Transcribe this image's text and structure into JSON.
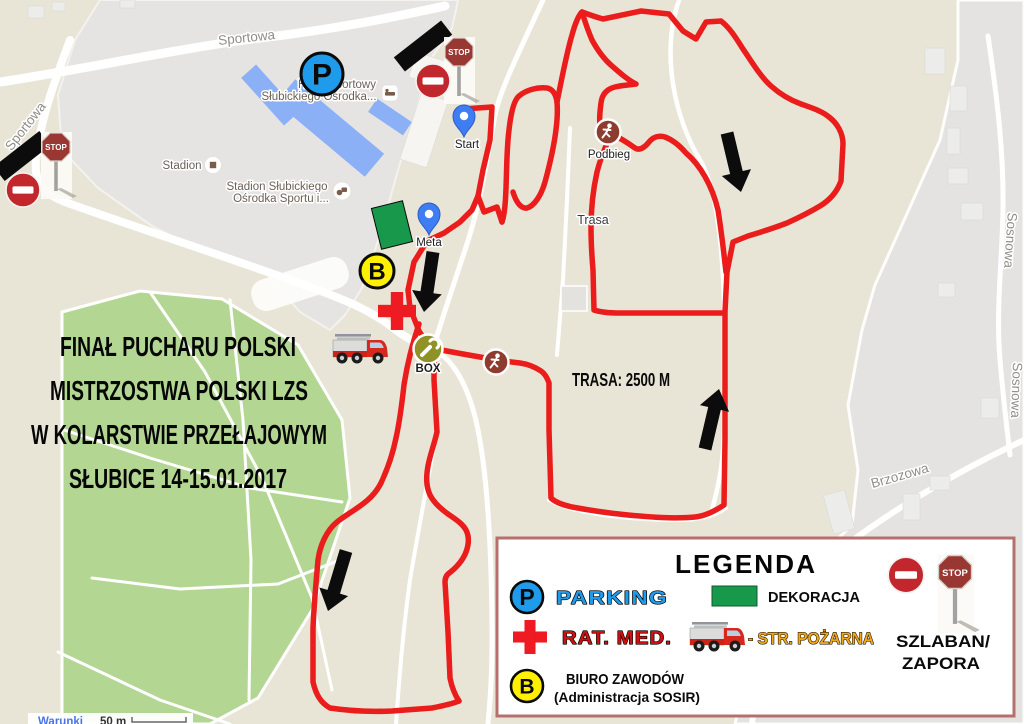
{
  "title": {
    "lines": [
      "FINAŁ PUCHARU POLSKI",
      "MISTRZOSTWA POLSKI LZS",
      "W KOLARSTWIE PRZEŁAJOWYM",
      "SŁUBICE 14-15.01.2017"
    ]
  },
  "course": {
    "distance": "TRASA: 2500 M"
  },
  "markers": {
    "p": "P",
    "b": "B",
    "box": "BOX",
    "stop": "STOP"
  },
  "labels": {
    "start": "Start",
    "meta": "Meta",
    "podbieg": "Podbieg",
    "trasa": "Trasa"
  },
  "streets": {
    "sportowa_top": "Sportowa",
    "sportowa_left": "Sportowa",
    "sosnowa_a": "Sosnowa",
    "sosnowa_b": "Sosnowa",
    "brzozowa": "Brzozowa"
  },
  "pois": {
    "stadion": "Stadion",
    "stadion_full_1": "Stadion Słubickiego",
    "stadion_full_2": "Ośrodka Sportu i...",
    "hotel_1": "Hotel Sportowy",
    "hotel_2": "Słubickiego Ośrodka..."
  },
  "legend": {
    "title": "LEGENDA",
    "parking": "PARKING",
    "dekoracja": "DEKORACJA",
    "rat_med": "RAT. MED.",
    "str_pozarna": "- STR. POŻARNA",
    "szlaban_1": "SZLABAN/",
    "szlaban_2": "ZAPORA",
    "biuro_1": "BIURO ZAWODÓW",
    "biuro_2": "(Administracja SOSIR)"
  },
  "footer": {
    "terms": "Warunki",
    "scale": "50 m"
  },
  "colors": {
    "route_red": "#ea1c1c",
    "parking_blue": "#1e9bea",
    "biuro_yellow": "#ffef00",
    "box_olive": "#8f9227",
    "runner_brown": "#8e3b30",
    "dekoracja_green": "#18984b",
    "no_entry_red": "#c1272d",
    "stop_sign_red": "#993733",
    "legend_border": "#b5706e",
    "park_green": "#b3d693",
    "land_beige": "#e9e5d6",
    "urban_gray": "#e5e4e2",
    "str_pozarna_orange": "#f2a71b",
    "rat_med_red": "#cc1111"
  }
}
